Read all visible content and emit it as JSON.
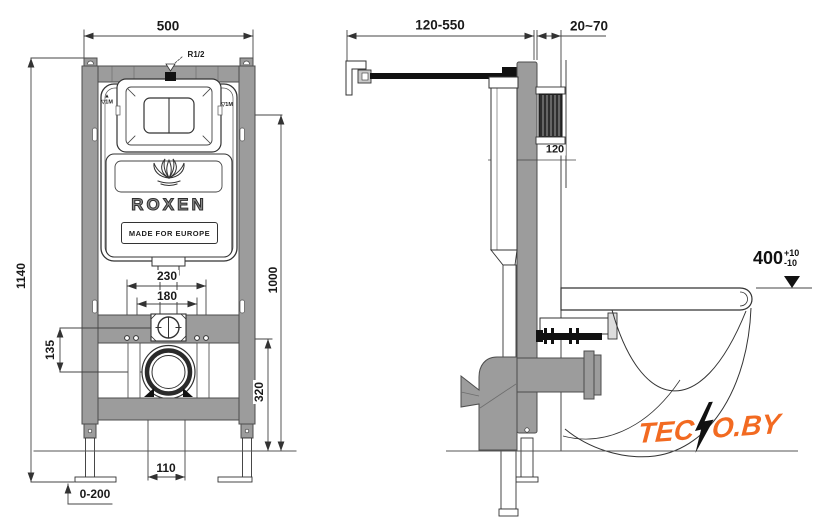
{
  "front_view": {
    "dim_width_top": "500",
    "dim_height_total": "1140",
    "dim_height_floor_to_mark": "1000",
    "dim_bolt_span_outer": "230",
    "dim_bolt_span_inner": "180",
    "dim_inlet_offset": "135",
    "dim_drain_center_height": "320",
    "dim_drain_pipe_width": "110",
    "dim_feet_adjust": "0-200",
    "inlet_thread_label": "R1/2",
    "level_mark_up": "▲",
    "level_mark_left": "▽1M",
    "level_mark_right": "▽1M"
  },
  "side_view": {
    "dim_bracket_reach": "120-550",
    "dim_wall_offset": "20~70",
    "dim_frame_depth": "120",
    "dim_rim_height": "400",
    "dim_rim_tol_plus": "+10",
    "dim_rim_tol_minus": "-10"
  },
  "cistern": {
    "brand": "ROXEN",
    "tagline": "MADE FOR EUROPE"
  },
  "watermark": {
    "full_name": "TECNO.BY",
    "brand_left": "TEC",
    "brand_right": "O.BY",
    "color": "#f26a21"
  },
  "colors": {
    "frame_gray": "#9c9c9c",
    "line_dark": "#3a3a3a",
    "hatch_dark": "#2e2e2e"
  }
}
